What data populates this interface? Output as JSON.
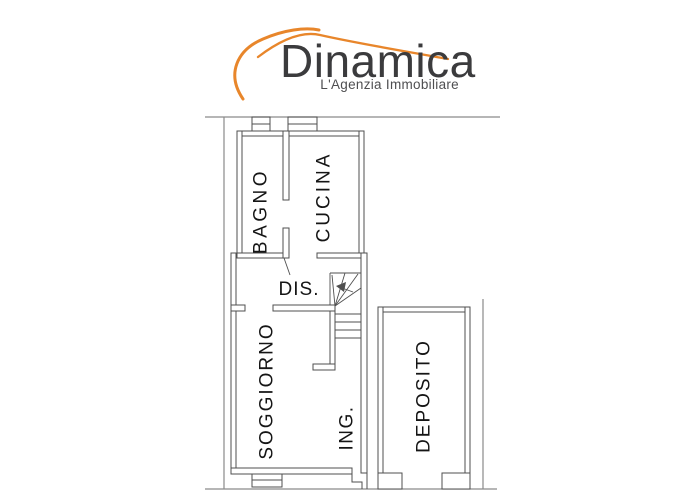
{
  "brand": {
    "title": "Dinamica",
    "subtitle": "L'Agenzia Immobiliare",
    "accent_color": "#E8862B",
    "title_color": "#3B3B3D",
    "subtitle_color": "#4E4E50"
  },
  "plan": {
    "wall_color": "#4F4F4F",
    "boundary_color": "#8A8A8A",
    "label_color": "#151515",
    "rooms": [
      {
        "label": "BAGNO"
      },
      {
        "label": "CUCINA"
      },
      {
        "label": "DIS."
      },
      {
        "label": "SOGGIORNO"
      },
      {
        "label": "ING."
      },
      {
        "label": "DEPOSITO"
      }
    ],
    "symbols": [
      "staircase-with-winders",
      "stair-direction-arrow",
      "window",
      "door-leaf"
    ]
  }
}
